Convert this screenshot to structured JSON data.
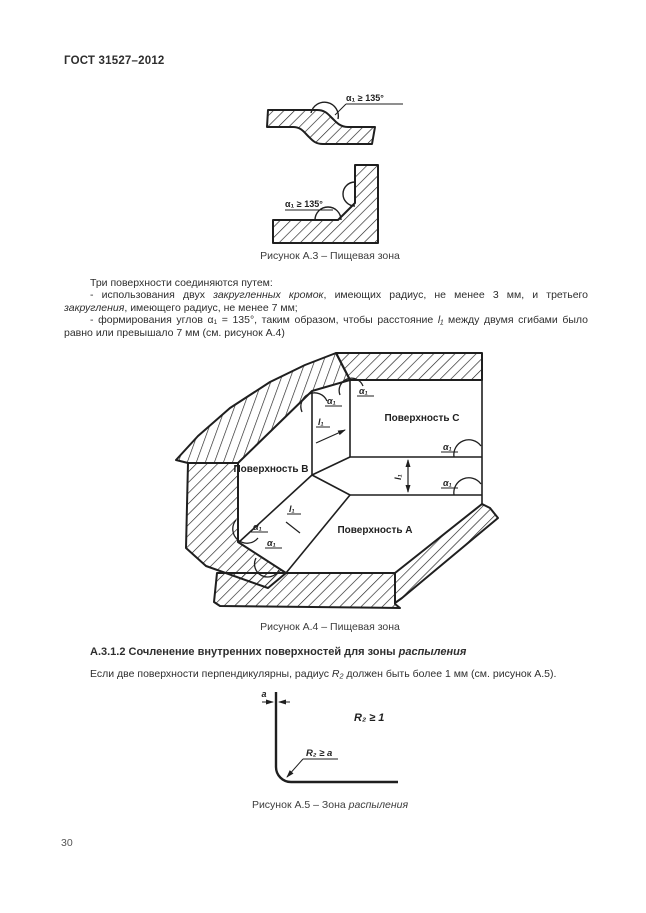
{
  "page": {
    "header_title": "ГОСТ 31527–2012",
    "page_number": "30"
  },
  "figure_a3": {
    "angle_label_step": "α₁ ≥ 135°",
    "angle_label_corner": "α₁ ≥ 135°",
    "caption": "Рисунок А.3 – Пищевая зона"
  },
  "body_text": {
    "intro": "Три поверхности соединяются путем:",
    "item1_pre": "- использования двух ",
    "item1_italic1": "закругленных кромок",
    "item1_mid": ", имеющих радиус, не менее 3 мм, и третьего ",
    "item1_italic2": "закругления",
    "item1_post": ", имеющего радиус, не менее 7 мм;",
    "item2_pre": "- формирования углов α₁ = 135°, таким образом, чтобы расстояние ",
    "item2_var": "l₁",
    "item2_post": " между двумя сгибами было равно или превышало 7 мм (см. рисунок А.4)"
  },
  "figure_a4": {
    "surface_a": "Поверхность А",
    "surface_b": "Поверхность В",
    "surface_c": "Поверхность С",
    "alpha_label": "α₁",
    "length_label": "l₁",
    "caption": "Рисунок А.4 – Пищевая зона"
  },
  "section_a312": {
    "heading_pre": "А.3.1.2 Сочленение внутренних поверхностей для зоны ",
    "heading_italic": "распыления",
    "body_pre": "Если две поверхности перпендикулярны, радиус ",
    "body_var": "R₂",
    "body_post": " должен быть более 1 мм (см. рисунок А.5)."
  },
  "figure_a5": {
    "thickness_label": "a",
    "radius_note": "R₂ ≥ 1",
    "radius_callout": "R₂ ≥ a",
    "caption_pre": "Рисунок А.5 – Зона ",
    "caption_italic": "распыления"
  }
}
